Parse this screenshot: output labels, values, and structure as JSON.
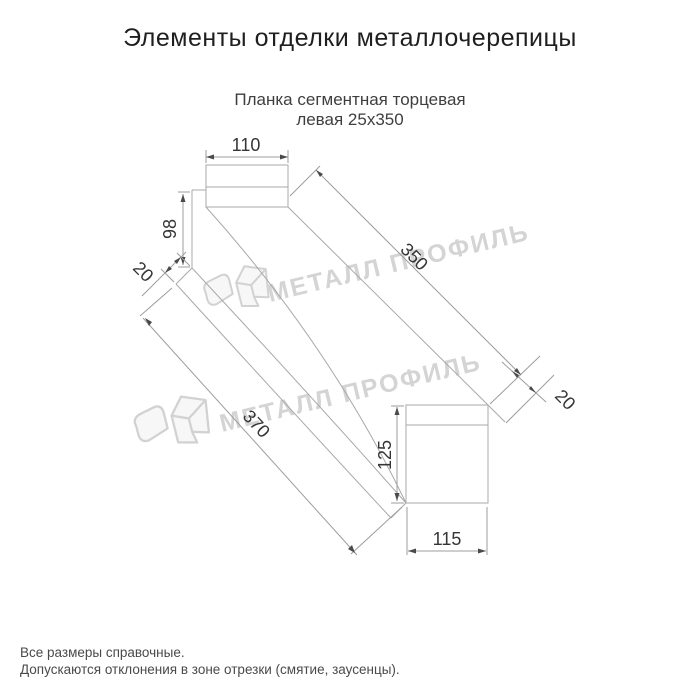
{
  "page": {
    "title": "Элементы отделки металлочерепицы"
  },
  "drawing": {
    "subtitle_line1": "Планка сегментная торцевая",
    "subtitle_line2": "левая 25х350",
    "dimensions": {
      "top_width": "110",
      "left_height": "98",
      "left_hem": "20",
      "top_edge_length": "350",
      "bottom_edge_length": "370",
      "right_hem": "20",
      "right_height": "125",
      "bottom_width": "115"
    },
    "watermark": {
      "brand": "МЕТАЛЛ ПРОФИЛЬ",
      "color": "#d4d4d4"
    },
    "line_color": "#a9a9a9",
    "dim_text_color": "#353535"
  },
  "footer": {
    "note1": "Все размеры справочные.",
    "note2": "Допускаются отклонения в зоне отрезки (смятие, заусенцы)."
  }
}
